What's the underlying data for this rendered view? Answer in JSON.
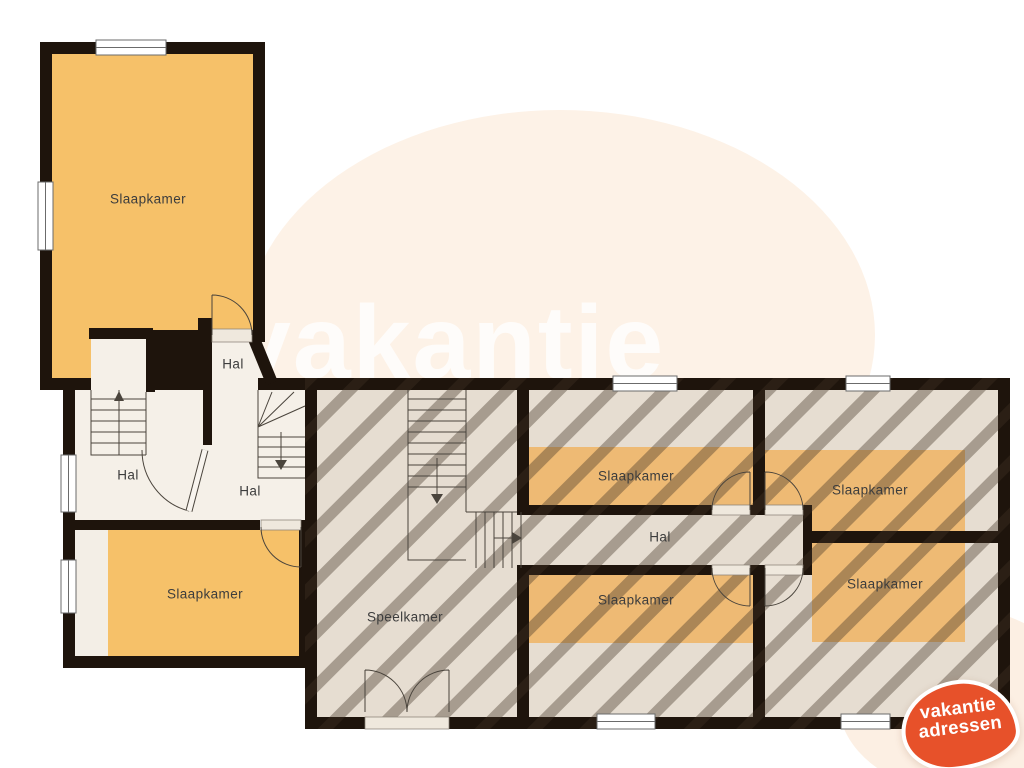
{
  "watermark": {
    "text": "vakantie"
  },
  "logo": {
    "line1": "vakantie",
    "line2": "adressen",
    "color": "#e7512a"
  },
  "labels": [
    {
      "name": "slaapkamer-top-left",
      "text": "Slaapkamer"
    },
    {
      "name": "hal-upper-small",
      "text": "Hal"
    },
    {
      "name": "hal-left",
      "text": "Hal"
    },
    {
      "name": "hal-right",
      "text": "Hal"
    },
    {
      "name": "slaapkamer-bottom-left",
      "text": "Slaapkamer"
    },
    {
      "name": "speelkamer",
      "text": "Speelkamer"
    },
    {
      "name": "slaapkamer-top-middle",
      "text": "Slaapkamer"
    },
    {
      "name": "hal-corridor",
      "text": "Hal"
    },
    {
      "name": "slaapkamer-top-right",
      "text": "Slaapkamer"
    },
    {
      "name": "slaapkamer-bottom-middle",
      "text": "Slaapkamer"
    },
    {
      "name": "slaapkamer-bottom-right",
      "text": "Slaapkamer"
    }
  ],
  "colors": {
    "wall": "#1e140c",
    "room_orange": "#f6c169",
    "attic_band_orange": "#eeba74",
    "floor_cream": "#f5f0e8",
    "wing_floor": "#e6ddd1",
    "hatch_stripe": "#3e3226",
    "watermark_blob": "#fdf2e7",
    "logo_orange": "#e7512a",
    "label_text": "#3d3d3d"
  }
}
